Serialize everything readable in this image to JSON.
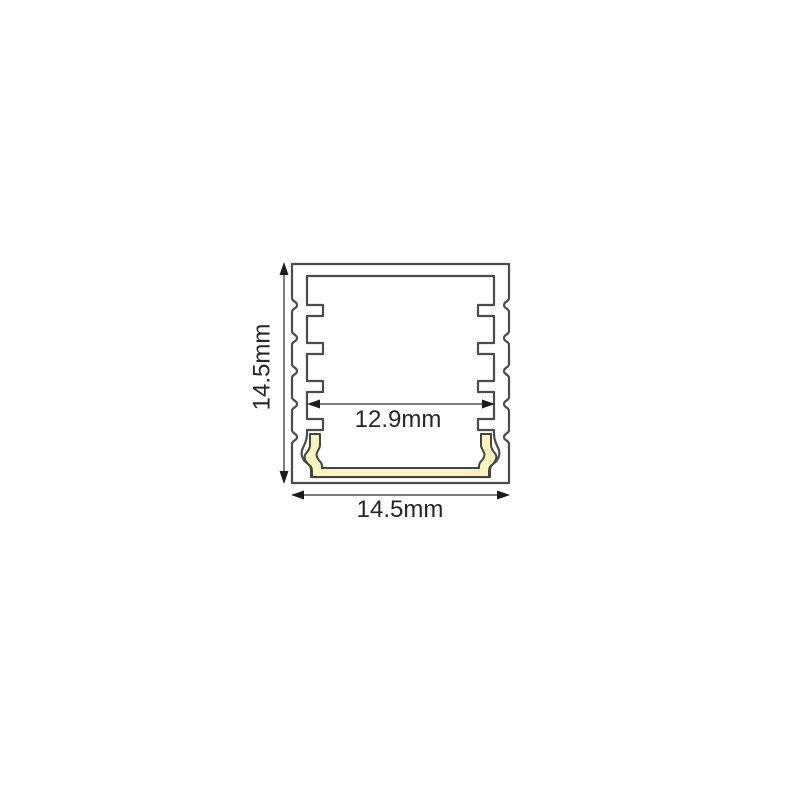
{
  "diagram": {
    "labels": {
      "overall_height": "14.5mm",
      "overall_width": "14.5mm",
      "inner_width": "12.9mm"
    },
    "colors": {
      "background": "#FFFFFF",
      "profile_outline": "#4C4C4C",
      "profile_fill": "#FFFFFF",
      "insert_fill": "#FAF3BE",
      "insert_outline": "#45443C",
      "dimension_line": "#7C7C7C",
      "arrowhead": "#1C1C1C",
      "label_text": "#262626"
    }
  }
}
